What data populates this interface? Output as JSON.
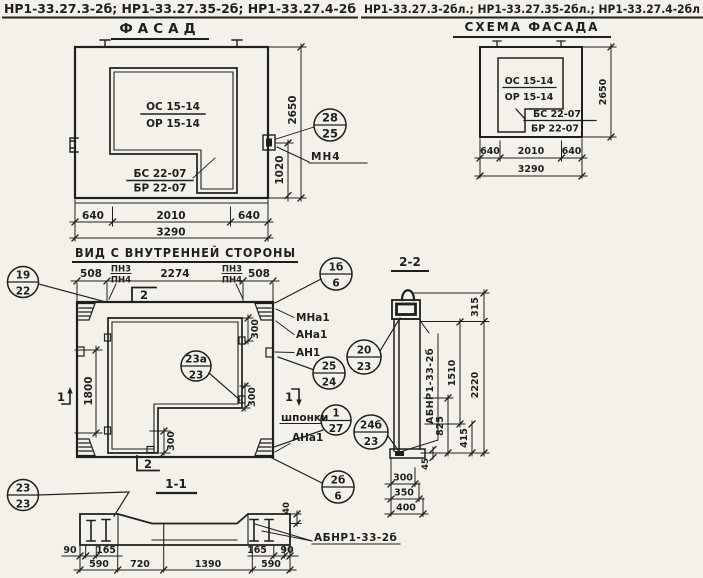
{
  "titles": {
    "left": "НР1-33.27.3-2б; НР1-33.27.35-2б; НР1-33.27.4-2б",
    "right": "НР1-33.27.3-2бл.; НР1-33.27.35-2бл.; НР1-33.27.4-2бл"
  },
  "facade": {
    "title": "ФАСАД",
    "window_mark_top": "ОС 15-14",
    "window_mark_bottom": "ОР 15-14",
    "balcony_mark_top": "БС 22-07",
    "balcony_mark_bottom": "БР 22-07",
    "anchor_label": "МН4",
    "callout": {
      "top": "28",
      "bottom": "25"
    },
    "dims": {
      "left": "640",
      "mid": "2010",
      "right": "640",
      "total": "3290",
      "height": "2650",
      "anchor": "1020"
    }
  },
  "scheme": {
    "title": "СХЕМА ФАСАДА",
    "window_mark_top": "ОС 15-14",
    "window_mark_bottom": "ОР 15-14",
    "balcony_mark_top": "БС 22-07",
    "balcony_mark_bottom": "БР 22-07",
    "dims": {
      "left": "640",
      "mid": "2010",
      "right": "640",
      "total": "3290",
      "height": "2650"
    }
  },
  "inner": {
    "title": "ВИД С ВНУТРЕННЕЙ СТОРОНЫ",
    "pn": {
      "top": "ПН3",
      "bottom": "ПН4"
    },
    "labels": {
      "mna1": "МНа1",
      "ana1": "АНа1",
      "an1": "АН1",
      "shponki": "шпонки"
    },
    "sections": {
      "s1": "1",
      "s2": "2"
    },
    "dims": {
      "left": "508",
      "mid": "2274",
      "right": "508",
      "height": "1800",
      "key_top": "300",
      "key_mid": "300",
      "key_bottom": "300"
    },
    "callouts": {
      "c19": {
        "top": "19",
        "bottom": "22"
      },
      "c1b": {
        "top": "1б",
        "bottom": "6"
      },
      "c20": {
        "top": "20",
        "bottom": "23"
      },
      "c25": {
        "top": "25",
        "bottom": "24"
      },
      "c23a": {
        "top": "23а",
        "bottom": "23"
      },
      "c1": {
        "top": "1",
        "bottom": "27"
      },
      "c24b": {
        "top": "24б",
        "bottom": "23"
      },
      "c2b": {
        "top": "2б",
        "bottom": "6"
      }
    }
  },
  "section22": {
    "title": "2-2",
    "panel_label": "АБНР1-33-2б",
    "dims": {
      "top": "315",
      "mid": "1510",
      "total": "2220",
      "lower": "825",
      "bottom": "415",
      "base": "45",
      "w1": "300",
      "w2": "350",
      "w3": "400"
    }
  },
  "section11": {
    "title": "1-1",
    "panel_label": "АБНР1-33-2б",
    "callout": {
      "top": "23",
      "bottom": "23"
    },
    "dims": {
      "l90": "90",
      "l165": "165",
      "r165": "165",
      "r90": "90",
      "top": "40",
      "b1": "590",
      "b2": "720",
      "b3": "1390",
      "b4": "590"
    }
  }
}
